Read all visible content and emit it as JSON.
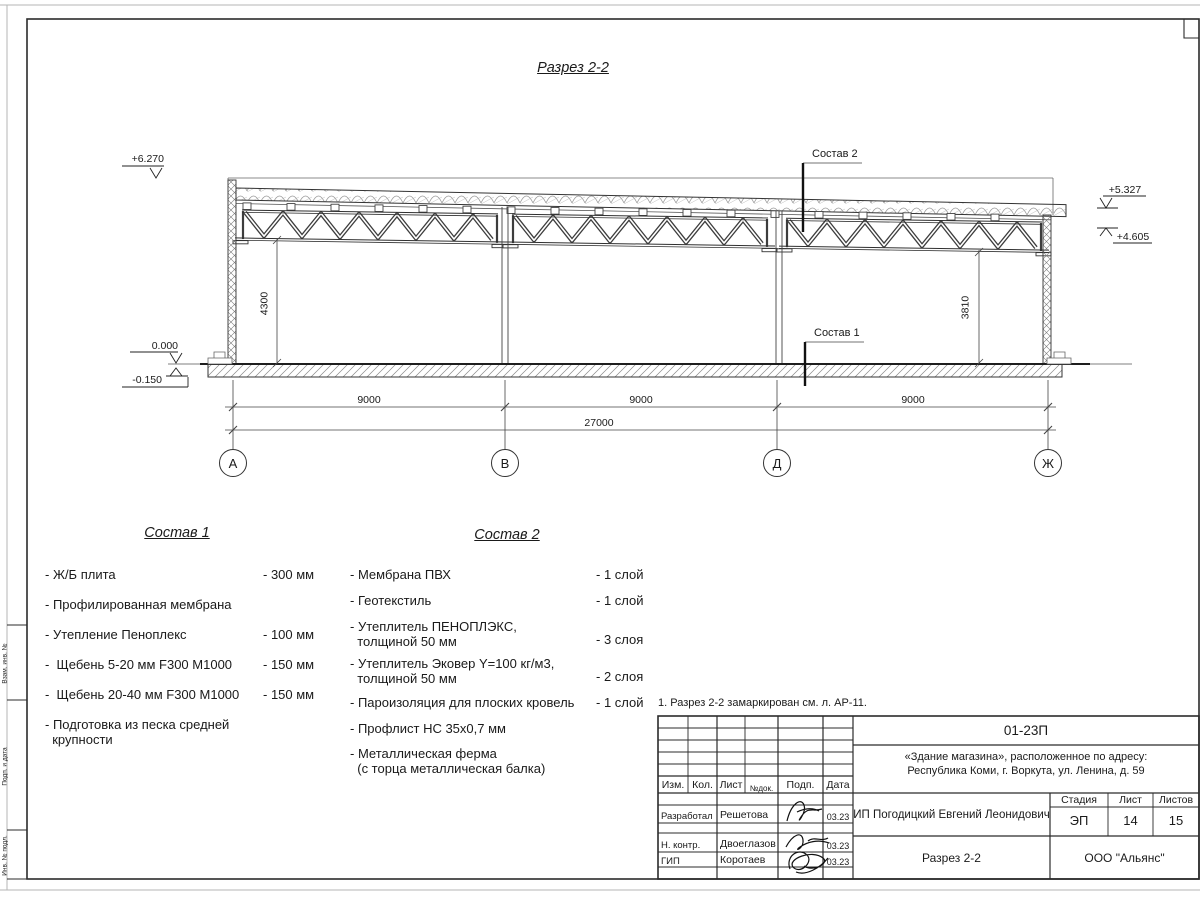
{
  "sheet": {
    "title": "Разрез 2-2",
    "note": "1. Разрез 2-2 замаркирован см. л. АР-11."
  },
  "drawing": {
    "elevations": {
      "top_left": "+6.270",
      "zero": "0.000",
      "below_zero": "-0.150",
      "roof_right": "+5.327",
      "truss_right": "+4.605"
    },
    "dims": {
      "bay": "9000",
      "total": "27000",
      "height_left": "4300",
      "height_right": "3810"
    },
    "grid": [
      "А",
      "В",
      "Д",
      "Ж"
    ]
  },
  "sostav1": {
    "heading": "Состав 1",
    "items": [
      {
        "name": "- Ж/Б плита",
        "value": "- 300 мм"
      },
      {
        "name": "- Профилированная мембрана"
      },
      {
        "name": "- Утепление Пеноплекс",
        "value": "- 100 мм"
      },
      {
        "name": "-  Щебень 5-20 мм F300 М1000",
        "value": "- 150 мм"
      },
      {
        "name": "-  Щебень 20-40 мм F300 М1000",
        "value": "- 150 мм"
      },
      {
        "name": "- Подготовка из песка средней\n  крупности"
      }
    ]
  },
  "sostav2": {
    "heading": "Состав 2",
    "items": [
      {
        "name": "- Мембрана ПВХ",
        "value": "- 1 слой"
      },
      {
        "name": "- Геотекстиль",
        "value": "- 1 слой"
      },
      {
        "name": "- Утеплитель ПЕНОПЛЭКС,\n  толщиной 50 мм",
        "value": "- 3 слоя"
      },
      {
        "name": "- Утеплитель Эковер Y=100 кг/м3,\n  толщиной 50 мм",
        "value": "- 2 слоя"
      },
      {
        "name": "- Пароизоляция для плоских кровель",
        "value": "- 1 слой"
      },
      {
        "name": "- Профлист НС 35х0,7 мм"
      },
      {
        "name": "- Металлическая ферма\n  (с торца металлическая балка)"
      }
    ]
  },
  "titleblock": {
    "doc_number": "01-23П",
    "object_line1": "«Здание магазина», расположенное по адресу:",
    "object_line2": "Республика Коми, г. Воркута, ул. Ленина, д. 59",
    "client": "ИП Погодицкий Евгений Леонидович",
    "sheet_name": "Разрез 2-2",
    "company": "ООО \"Альянс\"",
    "cols": {
      "izm": "Изм.",
      "kol": "Кол.",
      "list": "Лист",
      "ndok": "№док.",
      "podp": "Подп.",
      "data": "Дата"
    },
    "stage_label": "Стадия",
    "sheet_label": "Лист",
    "sheets_label": "Листов",
    "stage": "ЭП",
    "sheet_no": "14",
    "sheets_total": "15",
    "rows": [
      {
        "role": "Разработал",
        "name": "Решетова",
        "date": "03.23"
      },
      {
        "role": "Н. контр.",
        "name": "Двоеглазов",
        "date": "03.23"
      },
      {
        "role": "ГИП",
        "name": "Коротаев",
        "date": "03.23"
      }
    ]
  },
  "side_stamp": {
    "labels": [
      "Взам. инв. №",
      "Подп. и дата",
      "Инв. № подл."
    ]
  }
}
